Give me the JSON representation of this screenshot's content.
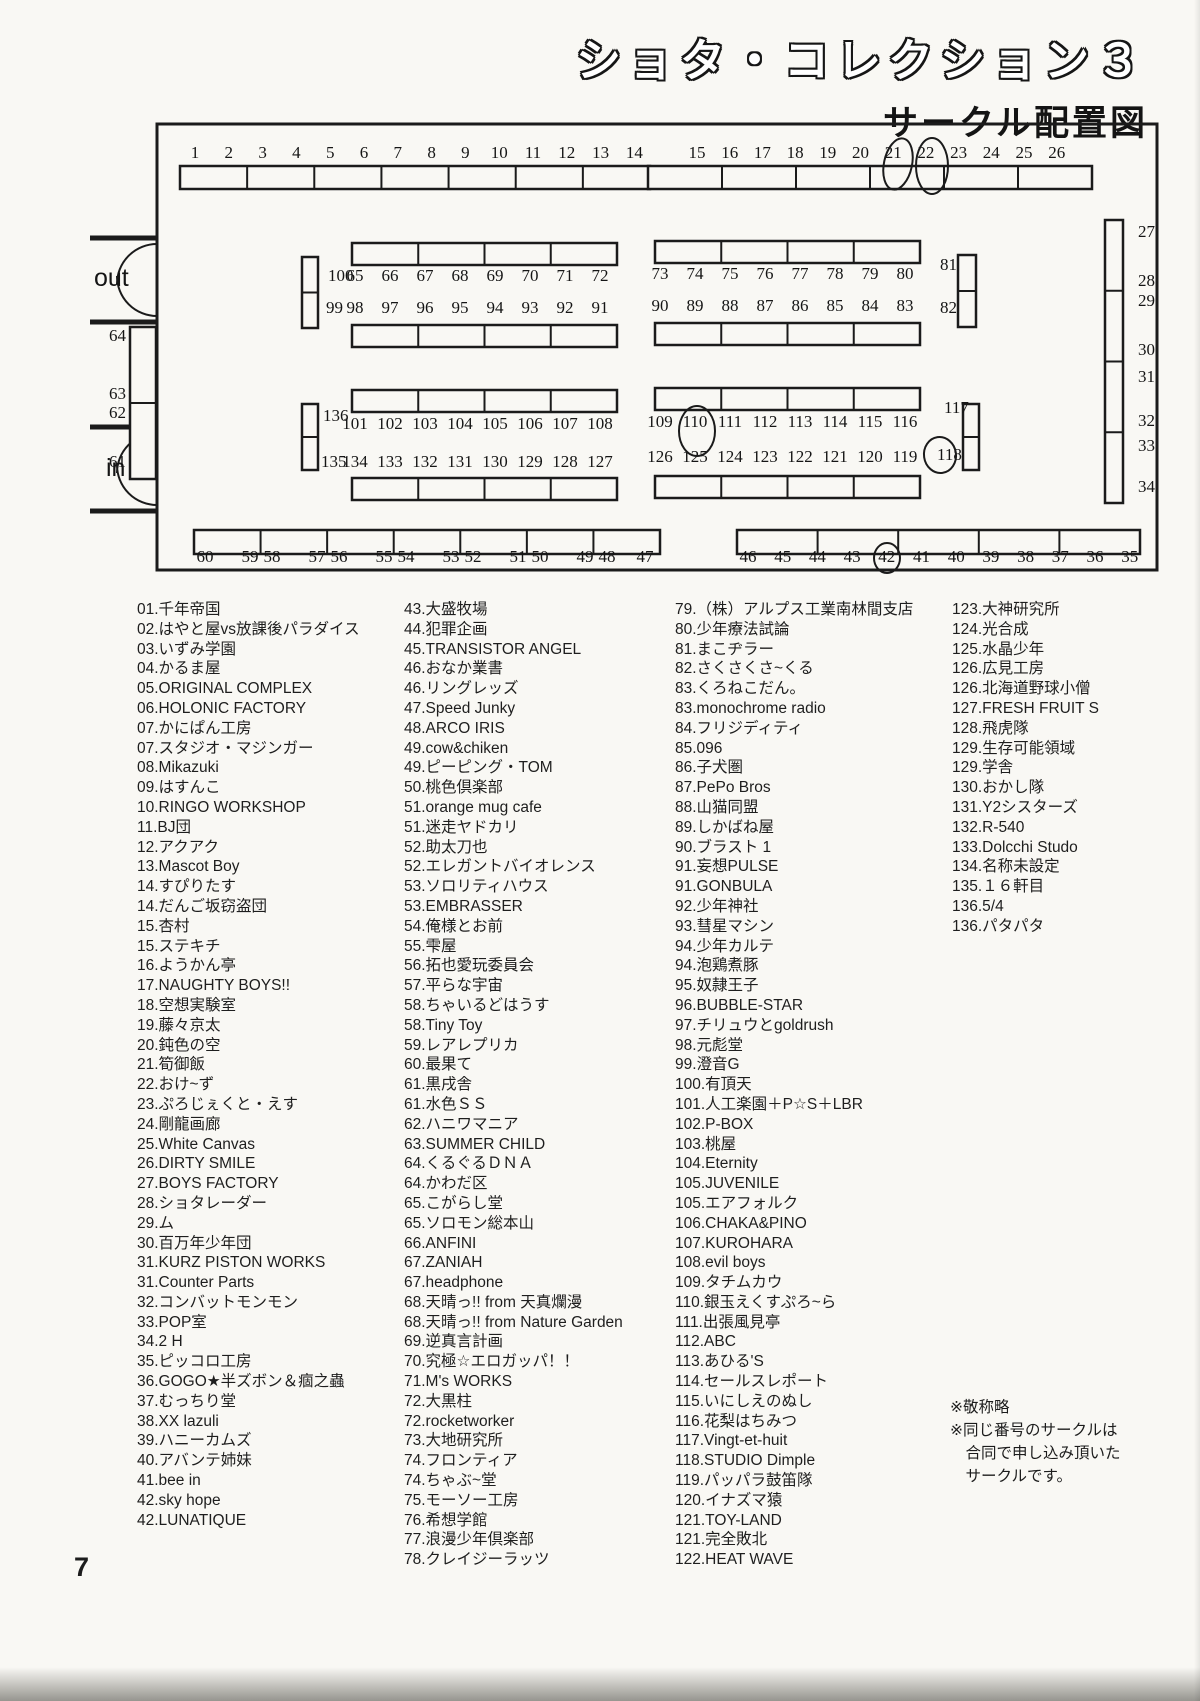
{
  "header": {
    "title": "ショタ・コレクション３",
    "subtitle": "サークル配置図"
  },
  "page": {
    "number": "7"
  },
  "map": {
    "htables": [
      {
        "x": 100,
        "y": 48,
        "w": 470,
        "h": 23,
        "segs": 7
      },
      {
        "x": 568,
        "y": 48,
        "w": 444,
        "h": 23,
        "segs": 6
      },
      {
        "x": 272,
        "y": 125,
        "w": 265,
        "h": 22,
        "segs": 4
      },
      {
        "x": 272,
        "y": 207,
        "w": 265,
        "h": 22,
        "segs": 4
      },
      {
        "x": 575,
        "y": 123,
        "w": 265,
        "h": 22,
        "segs": 4
      },
      {
        "x": 575,
        "y": 205,
        "w": 265,
        "h": 22,
        "segs": 4
      },
      {
        "x": 272,
        "y": 272,
        "w": 265,
        "h": 22,
        "segs": 4
      },
      {
        "x": 272,
        "y": 360,
        "w": 265,
        "h": 22,
        "segs": 4
      },
      {
        "x": 575,
        "y": 270,
        "w": 265,
        "h": 22,
        "segs": 4
      },
      {
        "x": 575,
        "y": 358,
        "w": 265,
        "h": 22,
        "segs": 4
      },
      {
        "x": 114,
        "y": 412,
        "w": 466,
        "h": 24,
        "segs": 7
      },
      {
        "x": 657,
        "y": 412,
        "w": 403,
        "h": 24,
        "segs": 5
      }
    ],
    "vtables": [
      {
        "x": 50,
        "y": 209,
        "w": 26,
        "h": 152,
        "segs": 2
      },
      {
        "x": 222,
        "y": 139,
        "w": 16,
        "h": 71,
        "segs": 2
      },
      {
        "x": 878,
        "y": 137,
        "w": 18,
        "h": 72,
        "segs": 2
      },
      {
        "x": 222,
        "y": 286,
        "w": 16,
        "h": 66,
        "segs": 2
      },
      {
        "x": 883,
        "y": 286,
        "w": 16,
        "h": 66,
        "segs": 2
      },
      {
        "x": 1025,
        "y": 102,
        "w": 18,
        "h": 283,
        "segs": 4
      }
    ],
    "number_rows": [
      {
        "y": 40,
        "x0": 115,
        "dx": 33.8,
        "labels": [
          "1",
          "2",
          "3",
          "4",
          "5",
          "6",
          "7",
          "8",
          "9",
          "10",
          "11",
          "12",
          "13",
          "14"
        ],
        "circled": []
      },
      {
        "y": 40,
        "x0": 617,
        "dx": 32.7,
        "labels": [
          "15",
          "16",
          "17",
          "18",
          "19",
          "20",
          "21",
          "22",
          "23",
          "24",
          "25",
          "26"
        ],
        "circled": [
          "21",
          "22"
        ]
      },
      {
        "y": 163,
        "x0": 275,
        "dx": 35,
        "labels": [
          "65",
          "66",
          "67",
          "68",
          "69",
          "70",
          "71",
          "72"
        ],
        "circled": []
      },
      {
        "y": 195,
        "x0": 275,
        "dx": 35,
        "labels": [
          "98",
          "97",
          "96",
          "95",
          "94",
          "93",
          "92",
          "91"
        ],
        "circled": []
      },
      {
        "y": 161,
        "x0": 580,
        "dx": 35,
        "labels": [
          "73",
          "74",
          "75",
          "76",
          "77",
          "78",
          "79",
          "80"
        ],
        "circled": []
      },
      {
        "y": 193,
        "x0": 580,
        "dx": 35,
        "labels": [
          "90",
          "89",
          "88",
          "87",
          "86",
          "85",
          "84",
          "83"
        ],
        "circled": []
      },
      {
        "y": 311,
        "x0": 275,
        "dx": 35,
        "labels": [
          "101",
          "102",
          "103",
          "104",
          "105",
          "106",
          "107",
          "108"
        ],
        "circled": []
      },
      {
        "y": 349,
        "x0": 275,
        "dx": 35,
        "labels": [
          "134",
          "133",
          "132",
          "131",
          "130",
          "129",
          "128",
          "127"
        ],
        "circled": []
      },
      {
        "y": 309,
        "x0": 580,
        "dx": 35,
        "labels": [
          "109",
          "110",
          "111",
          "112",
          "113",
          "114",
          "115",
          "116"
        ],
        "circled": [
          "110"
        ]
      },
      {
        "y": 344,
        "x0": 580,
        "dx": 35,
        "labels": [
          "126",
          "125",
          "124",
          "123",
          "122",
          "121",
          "120",
          "119"
        ],
        "circled": []
      },
      {
        "y": 444,
        "xs": [
          125,
          170,
          192,
          237,
          259,
          304,
          326,
          371,
          393,
          438,
          460,
          505,
          527,
          565
        ],
        "labels": [
          "60",
          "59",
          "58",
          "57",
          "56",
          "55",
          "54",
          "53",
          "52",
          "51",
          "50",
          "49",
          "48",
          "47"
        ],
        "circled": []
      },
      {
        "y": 444,
        "x0": 668,
        "dx": 34.7,
        "labels": [
          "46",
          "45",
          "44",
          "43",
          "42",
          "41",
          "40",
          "39",
          "38",
          "37",
          "36",
          "35"
        ],
        "circled": [
          "42"
        ]
      }
    ],
    "side_labels": [
      {
        "t": "100",
        "x": 248,
        "y": 163,
        "a": "start"
      },
      {
        "t": "99",
        "x": 246,
        "y": 195,
        "a": "start"
      },
      {
        "t": "81",
        "x": 860,
        "y": 152,
        "a": "start"
      },
      {
        "t": "82",
        "x": 860,
        "y": 195,
        "a": "start"
      },
      {
        "t": "136",
        "x": 243,
        "y": 303,
        "a": "start"
      },
      {
        "t": "135",
        "x": 241,
        "y": 349,
        "a": "start"
      },
      {
        "t": "117",
        "x": 864,
        "y": 295,
        "a": "start"
      },
      {
        "t": "118",
        "x": 857,
        "y": 342,
        "a": "start"
      },
      {
        "t": "64",
        "x": 46,
        "y": 223,
        "a": "end"
      },
      {
        "t": "63",
        "x": 46,
        "y": 281,
        "a": "end"
      },
      {
        "t": "62",
        "x": 46,
        "y": 300,
        "a": "end"
      },
      {
        "t": "61",
        "x": 46,
        "y": 349,
        "a": "end"
      },
      {
        "t": "27",
        "x": 1058,
        "y": 119,
        "a": "start"
      },
      {
        "t": "28",
        "x": 1058,
        "y": 168,
        "a": "start"
      },
      {
        "t": "29",
        "x": 1058,
        "y": 188,
        "a": "start"
      },
      {
        "t": "30",
        "x": 1058,
        "y": 237,
        "a": "start"
      },
      {
        "t": "31",
        "x": 1058,
        "y": 264,
        "a": "start"
      },
      {
        "t": "32",
        "x": 1058,
        "y": 308,
        "a": "start"
      },
      {
        "t": "33",
        "x": 1058,
        "y": 333,
        "a": "start"
      },
      {
        "t": "34",
        "x": 1058,
        "y": 374,
        "a": "start"
      },
      {
        "t": "out",
        "x": 14,
        "y": 168,
        "a": "start",
        "f": "sans",
        "s": 25
      },
      {
        "t": "in",
        "x": 26,
        "y": 358,
        "a": "start",
        "f": "sans",
        "s": 25
      }
    ],
    "circles": [
      {
        "cx": 818,
        "cy": 46,
        "rx": 14,
        "ry": 26,
        "rot": 12
      },
      {
        "cx": 852,
        "cy": 48,
        "rx": 16,
        "ry": 28,
        "rot": 0
      },
      {
        "cx": 617,
        "cy": 313,
        "rx": 18,
        "ry": 25,
        "rot": 0
      },
      {
        "cx": 860,
        "cy": 337,
        "rx": 16,
        "ry": 18,
        "rot": -8
      },
      {
        "cx": 807,
        "cy": 440,
        "rx": 13,
        "ry": 15,
        "rot": 0
      }
    ]
  },
  "columns": [
    [
      "01.千年帝国",
      "02.はやと屋vs放課後パラダイス",
      "03.いずみ学園",
      "04.かるま屋",
      "05.ORIGINAL COMPLEX",
      "06.HOLONIC FACTORY",
      "07.かにぱん工房",
      "07.スタジオ・マジンガー",
      "08.Mikazuki",
      "09.はすんこ",
      "10.RINGO WORKSHOP",
      "11.BJ団",
      "12.アクアク",
      "13.Mascot Boy",
      "14.すぴりたす",
      "14.だんご坂窃盗団",
      "15.杏村",
      "15.ステキチ",
      "16.ようかん亭",
      "17.NAUGHTY BOYS!!",
      "18.空想実験室",
      "19.藤々京太",
      "20.鈍色の空",
      "21.筍御飯",
      "22.おけ~ず",
      "23.ぷろじぇくと・えす",
      "24.剛龍画廊",
      "25.White Canvas",
      "26.DIRTY SMILE",
      "27.BOYS FACTORY",
      "28.ショタレーダー",
      "29.ム",
      "30.百万年少年団",
      "31.KURZ PISTON WORKS",
      "31.Counter Parts",
      "32.コンバットモンモン",
      "33.POP室",
      "34.2 H",
      "35.ピッコロ工房",
      "36.GOGO★半ズボン＆痼之蟲",
      "37.むっちり堂",
      "38.XX lazuli",
      "39.ハニーカムズ",
      "40.アバンテ姉妹",
      "41.bee in",
      "42.sky hope",
      "42.LUNATIQUE"
    ],
    [
      "43.大盛牧場",
      "44.犯罪企画",
      "45.TRANSISTOR ANGEL",
      "46.おなか業書",
      "46.リングレッズ",
      "47.Speed Junky",
      "48.ARCO IRIS",
      "49.cow&chiken",
      "49.ピーピング・TOM",
      "50.桃色倶楽部",
      "51.orange mug cafe",
      "51.迷走ヤドカリ",
      "52.助太刀也",
      "52.エレガントバイオレンス",
      "53.ソロリティハウス",
      "53.EMBRASSER",
      "54.俺様とお前",
      "55.雫屋",
      "56.拓也愛玩委員会",
      "57.平らな宇宙",
      "58.ちゃいるどはうす",
      "58.Tiny Toy",
      "59.レアレプリカ",
      "60.最果て",
      "61.黒戌舎",
      "61.水色ＳＳ",
      "62.ハニワマニア",
      "63.SUMMER CHILD",
      "64.くるぐるＤＮＡ",
      "64.かわだ区",
      "65.こがらし堂",
      "65.ソロモン総本山",
      "66.ANFINI",
      "67.ZANIAH",
      "67.headphone",
      "68.天晴っ!! from 天真爛漫",
      "68.天晴っ!! from Nature Garden",
      "69.逆真言計画",
      "70.究極☆エロガッパ！！",
      "71.M's WORKS",
      "72.大黒柱",
      "72.rocketworker",
      "73.大地研究所",
      "74.フロンティア",
      "74.ちゃぶ~堂",
      "75.モーソー工房",
      "76.希想学館",
      "77.浪漫少年倶楽部",
      "78.クレイジーラッツ"
    ],
    [
      "79.（株）アルプス工業南林間支店",
      "80.少年療法試論",
      "81.まこヂラー",
      "82.さくさくさ~くる",
      "83.くろねこだん。",
      "83.monochrome radio",
      "84.フリジディティ",
      "85.096",
      "86.子犬圏",
      "87.PePo Bros",
      "88.山猫同盟",
      "89.しかばね屋",
      "90.ブラスト 1",
      "91.妄想PULSE",
      "91.GONBULA",
      "92.少年神社",
      "93.彗星マシン",
      "94.少年カルテ",
      "94.泡鶏煮豚",
      "95.奴隷王子",
      "96.BUBBLE-STAR",
      "97.チリュウとgoldrush",
      "98.元彪堂",
      "99.澄音G",
      "100.有頂天",
      "101.人工楽園＋P☆S＋LBR",
      "102.P-BOX",
      "103.桃屋",
      "104.Eternity",
      "105.JUVENILE",
      "105.エアフォルク",
      "106.CHAKA&PINO",
      "107.KUROHARA",
      "108.evil boys",
      "109.タチムカウ",
      "110.銀玉えくすぷろ~ら",
      "111.出張風見亭",
      "112.ABC",
      "113.あひる'S",
      "114.セールスレポート",
      "115.いにしえのぬし",
      "116.花梨はちみつ",
      "117.Vingt-et-huit",
      "118.STUDIO Dimple",
      "119.パッパラ鼓笛隊",
      "120.イナズマ猿",
      "121.TOY-LAND",
      "121.完全敗北",
      "122.HEAT WAVE"
    ],
    [
      "123.大神研究所",
      "124.光合成",
      "125.水晶少年",
      "126.広見工房",
      "126.北海道野球小僧",
      "127.FRESH FRUIT S",
      "128.飛虎隊",
      "129.生存可能領域",
      "129.学舎",
      "130.おかし隊",
      "131.Y2シスターズ",
      "132.R-540",
      "133.Dolcchi Studo",
      "134.名称未設定",
      "135.１６軒目",
      "136.5/4",
      "136.パタパタ"
    ]
  ],
  "notes": [
    "※敬称略",
    "※同じ番号のサークルは",
    "　合同で申し込み頂いた",
    "　サークルです。"
  ]
}
